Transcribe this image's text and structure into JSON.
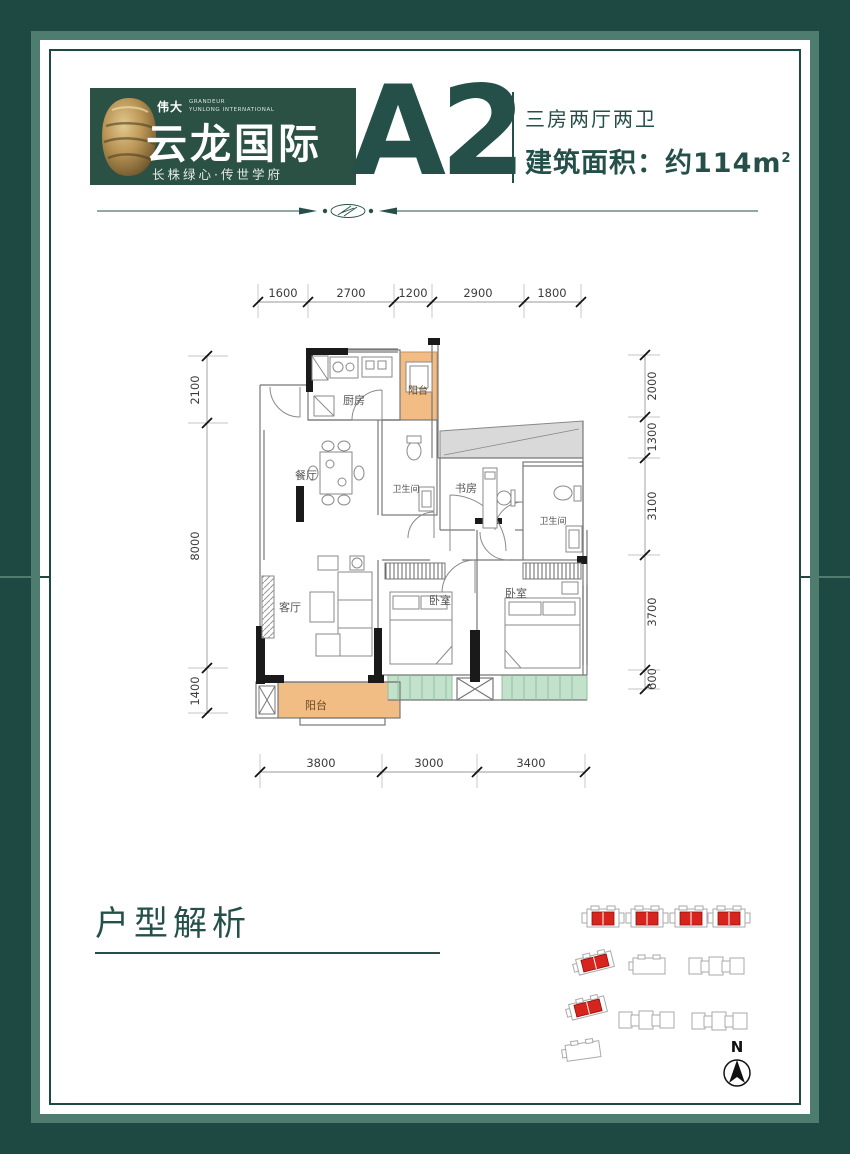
{
  "colors": {
    "frame": "#1E4942",
    "band": "#4E7D6F",
    "accent": "#25504A",
    "balcony": "#F2BC85",
    "bay_window": "#C2E2CB",
    "public_area": "#D9D9D9",
    "highlight_red": "#D7251D"
  },
  "header": {
    "logo": {
      "brand_cn": "伟大",
      "brand_en": "GRANDEUR",
      "brand_sub": "YUNLONG INTERNATIONAL",
      "name": "云龙国际",
      "tagline": "长株绿心·传世学府"
    },
    "unit_code": "A2",
    "unit_type": "三房两厅两卫",
    "area_text": "建筑面积：约114m",
    "area_sup": "2"
  },
  "plan": {
    "rooms": {
      "kitchen": "厨房",
      "balcony_top": "阳台",
      "dining": "餐厅",
      "bath_a": "卫生间",
      "study": "书房",
      "bath_b": "卫生间",
      "living": "客厅",
      "bed_a": "卧室",
      "bed_b": "卧室",
      "balcony_bottom": "阳台"
    },
    "dims": {
      "top": [
        "1600",
        "2700",
        "1200",
        "2900",
        "1800"
      ],
      "bottom": [
        "3800",
        "3000",
        "3400"
      ],
      "left": [
        "2100",
        "8000",
        "1400"
      ],
      "right": [
        "2000",
        "1300",
        "3100",
        "3700",
        "600"
      ]
    }
  },
  "analysis_title": "户型解析",
  "site": {
    "north_label": "N"
  }
}
